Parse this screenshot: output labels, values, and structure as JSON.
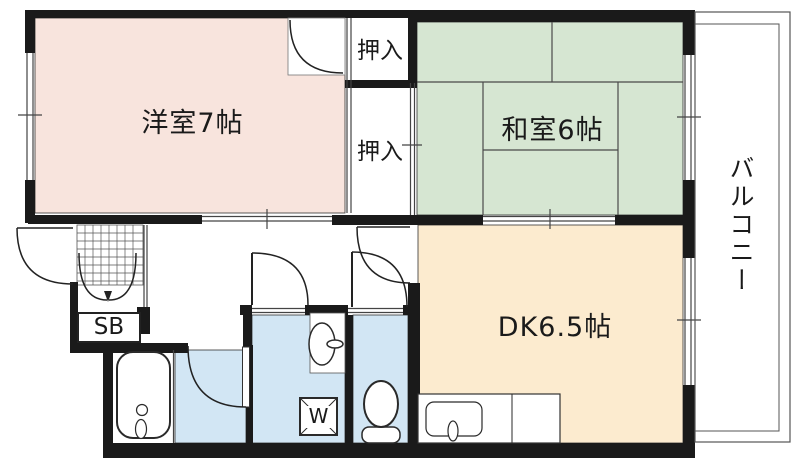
{
  "floorplan": {
    "rooms": {
      "western_room": {
        "label": "洋室7帖"
      },
      "japanese_room": {
        "label": "和室6帖"
      },
      "dining_kitchen": {
        "label": "DK6.5帖"
      },
      "closet_upper": {
        "label": "押入"
      },
      "closet_lower": {
        "label": "押入"
      },
      "balcony": {
        "label": "バルコニー"
      },
      "shoe_box": {
        "label": "SB"
      },
      "washing_machine": {
        "label": "W"
      }
    },
    "colors": {
      "western_room": "#f8e4dd",
      "japanese_room": "#d6e6d2",
      "dining_kitchen": "#fcebcf",
      "wet_area": "#d2e6f4",
      "wall": "#1a1a1a"
    }
  }
}
